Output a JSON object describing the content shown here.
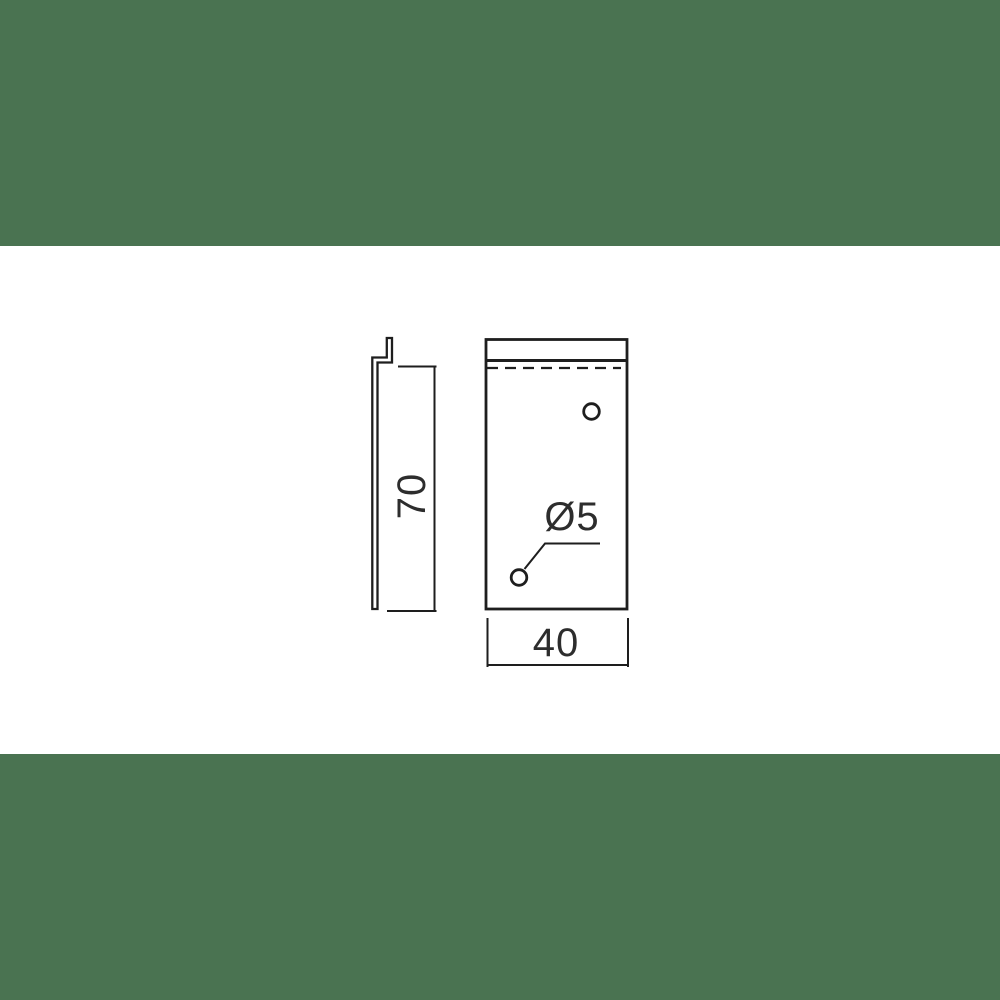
{
  "page": {
    "background_color": "#4a7351",
    "paper_color": "#ffffff",
    "line_color": "#1e1e1e",
    "text_color": "#2d2d2d"
  },
  "drawing": {
    "labels": {
      "height": "70",
      "width": "40",
      "hole_diameter": "Ø5"
    }
  }
}
